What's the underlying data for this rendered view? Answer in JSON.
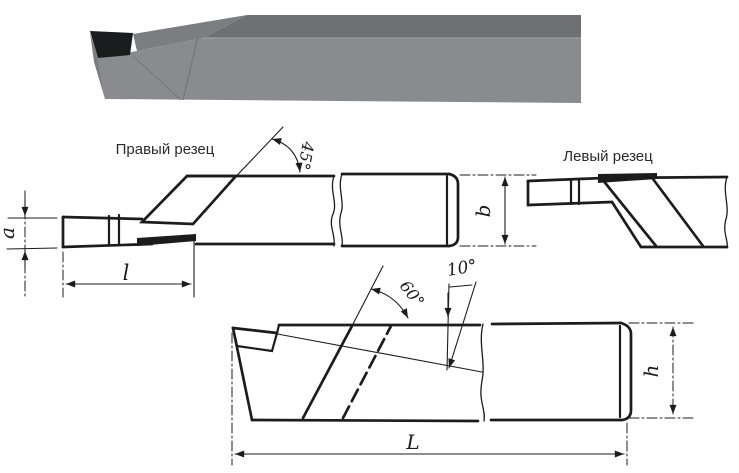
{
  "figure": {
    "right_cutter_label": "Правый резец",
    "left_cutter_label": "Левый  резец",
    "angle_45": "45°",
    "angle_60": "60°",
    "angle_10": "10°",
    "dim_a": "a",
    "dim_l": "l",
    "dim_b": "b",
    "dim_h": "h",
    "dim_L": "L"
  },
  "colors": {
    "line": "#1c1c1c",
    "label_text": "#2b2b2b",
    "background": "#ffffff",
    "photo_top_face": "#6f7073",
    "photo_slope_face": "#7c7d81",
    "photo_front_face": "#8a8b8e",
    "photo_edge_light": "#9b9c9f",
    "photo_crease": "#76777b",
    "carbide_insert": "#1b1c1e"
  }
}
